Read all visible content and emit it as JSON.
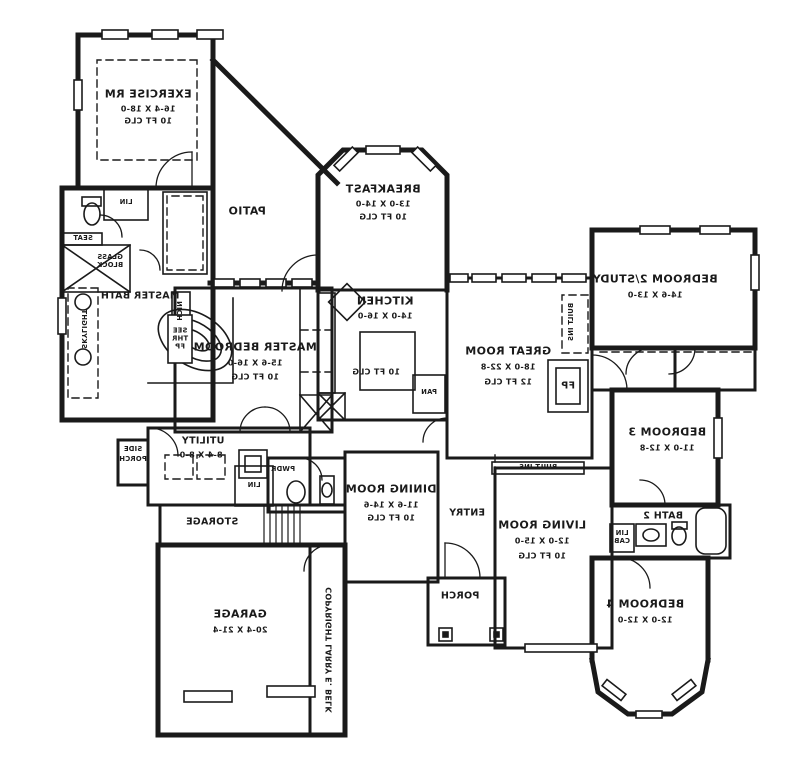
{
  "plan": {
    "title": "Mirrored residential floor plan",
    "credit": "COPYRIGHT LARRY E. BELK",
    "ink_color": "#1a1a1a",
    "paper_color": "#ffffff",
    "rooms": {
      "exercise": {
        "name": "EXERCISE RM",
        "dims": "16-4 X 18-0",
        "clg": "10 FT CLG"
      },
      "patio": {
        "name": "PATIO"
      },
      "breakfast": {
        "name": "BREAKFAST",
        "dims": "13-0 X 14-0",
        "clg": "10 FT CLG"
      },
      "kitchen": {
        "name": "KITCHEN",
        "dims": "14-0 X 16-0",
        "clg": "10 FT CLG"
      },
      "master_bath": {
        "name": "MASTER BATH"
      },
      "master_bedroom": {
        "name": "MASTER BEDROOM",
        "dims": "15-6 X 16-0",
        "clg": "10 FT CLG"
      },
      "great_room": {
        "name": "GREAT ROOM",
        "dims": "18-0 X 22-8",
        "clg": "12 FT CLG"
      },
      "bedroom2": {
        "name": "BEDROOM 2/STUDY",
        "dims": "14-6 X 13-0"
      },
      "bedroom3": {
        "name": "BEDROOM 3",
        "dims": "11-0 X 12-8"
      },
      "bath2": {
        "name": "BATH 2"
      },
      "bedroom4": {
        "name": "BEDROOM 4",
        "dims": "12-0 X 12-0"
      },
      "living": {
        "name": "LIVING ROOM",
        "dims": "12-0 X 15-0",
        "clg": "10 FT CLG"
      },
      "entry": {
        "name": "ENTRY"
      },
      "porch": {
        "name": "PORCH"
      },
      "dining": {
        "name": "DINING ROOM",
        "dims": "11-6 X 14-6",
        "clg": "10 FT CLG"
      },
      "utility": {
        "name": "UTILITY",
        "dims": "8-4 X 8-0"
      },
      "storage": {
        "name": "STORAGE"
      },
      "garage": {
        "name": "GARAGE",
        "dims": "20-4 X 21-4"
      },
      "side_porch": {
        "line1": "SIDE",
        "line2": "PORCH"
      }
    },
    "callouts": {
      "lin": "LIN",
      "lin_cab": "LIN CAB",
      "pwdr": "PWDR",
      "pan": "PAN",
      "fp": "FP",
      "see_thr_fp": "SEE THR FP",
      "nich": "NICH",
      "built_ins": "BUILT INS",
      "seat": "SEAT",
      "glass_block": "GLASS BLOCK",
      "skylight": "SKYLIGHT"
    }
  }
}
